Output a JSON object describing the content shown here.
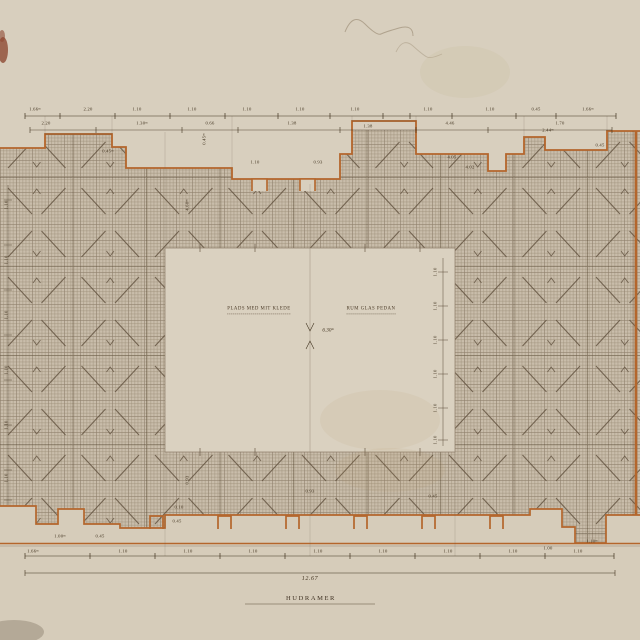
{
  "drawing": {
    "title": "HUDRAMER",
    "overall_dimension": "12.67",
    "center_dimension": "6.30ᵐ",
    "room_label_left": "PLADS MED MIT KLEDE",
    "room_label_right": "RUM GLAS PEDAN"
  },
  "colors": {
    "paper": "#d7cdbc",
    "wall_outline": "#b4662c",
    "ink": "#41331f",
    "hatch_field": "#c9bdab",
    "hatch_line": "#93866f"
  },
  "dim_labels": [
    {
      "x": 35,
      "y": 110,
      "t": "1.66ᵐ"
    },
    {
      "x": 88,
      "y": 110,
      "t": "2.20"
    },
    {
      "x": 137,
      "y": 110,
      "t": "1.10"
    },
    {
      "x": 192,
      "y": 110,
      "t": "1.10"
    },
    {
      "x": 247,
      "y": 110,
      "t": "1.10"
    },
    {
      "x": 300,
      "y": 110,
      "t": "1.10"
    },
    {
      "x": 355,
      "y": 110,
      "t": "1.10"
    },
    {
      "x": 428,
      "y": 110,
      "t": "1.10"
    },
    {
      "x": 490,
      "y": 110,
      "t": "1.10"
    },
    {
      "x": 536,
      "y": 110,
      "t": "0.45"
    },
    {
      "x": 588,
      "y": 110,
      "t": "1.66ᵐ"
    },
    {
      "x": 46,
      "y": 124,
      "t": "2.20"
    },
    {
      "x": 142,
      "y": 124,
      "t": "1.30ᵐ"
    },
    {
      "x": 210,
      "y": 124,
      "t": "0.66"
    },
    {
      "x": 292,
      "y": 124,
      "t": "1.38"
    },
    {
      "x": 368,
      "y": 127,
      "t": "1.38"
    },
    {
      "x": 450,
      "y": 124,
      "t": "4.46"
    },
    {
      "x": 560,
      "y": 124,
      "t": "1.70"
    },
    {
      "x": 205,
      "y": 139,
      "t": "0.45ᵐ",
      "r": true
    },
    {
      "x": 108,
      "y": 152,
      "t": "0.45ᵐ"
    },
    {
      "x": 255,
      "y": 163,
      "t": "1.10"
    },
    {
      "x": 318,
      "y": 163,
      "t": "0.93"
    },
    {
      "x": 452,
      "y": 158,
      "t": "4.05"
    },
    {
      "x": 470,
      "y": 168,
      "t": "4.02"
    },
    {
      "x": 548,
      "y": 131,
      "t": "2.44ᵐ"
    },
    {
      "x": 600,
      "y": 146,
      "t": "0.45"
    },
    {
      "x": 188,
      "y": 205,
      "t": "4.68ᵐ",
      "r": true
    },
    {
      "x": 188,
      "y": 480,
      "t": "0.93",
      "r": true
    },
    {
      "x": 310,
      "y": 492,
      "t": "0.93"
    },
    {
      "x": 433,
      "y": 497,
      "t": "0.45"
    },
    {
      "x": 7,
      "y": 205,
      "t": "1.10",
      "r": true
    },
    {
      "x": 7,
      "y": 260,
      "t": "1.10",
      "r": true
    },
    {
      "x": 7,
      "y": 315,
      "t": "1.10",
      "r": true
    },
    {
      "x": 7,
      "y": 370,
      "t": "1.10",
      "r": true
    },
    {
      "x": 7,
      "y": 425,
      "t": "1.10",
      "r": true
    },
    {
      "x": 7,
      "y": 478,
      "t": "1.10",
      "r": true
    },
    {
      "x": 436,
      "y": 272,
      "t": "1.10",
      "r": true
    },
    {
      "x": 436,
      "y": 306,
      "t": "1.10",
      "r": true
    },
    {
      "x": 436,
      "y": 340,
      "t": "1.10",
      "r": true
    },
    {
      "x": 436,
      "y": 374,
      "t": "1.10",
      "r": true
    },
    {
      "x": 436,
      "y": 408,
      "t": "1.10",
      "r": true
    },
    {
      "x": 436,
      "y": 440,
      "t": "1.10",
      "r": true
    },
    {
      "x": 33,
      "y": 552,
      "t": "1.66ᵐ"
    },
    {
      "x": 123,
      "y": 552,
      "t": "1.10"
    },
    {
      "x": 188,
      "y": 552,
      "t": "1.10"
    },
    {
      "x": 253,
      "y": 552,
      "t": "1.10"
    },
    {
      "x": 318,
      "y": 552,
      "t": "1.10"
    },
    {
      "x": 383,
      "y": 552,
      "t": "1.10"
    },
    {
      "x": 448,
      "y": 552,
      "t": "1.10"
    },
    {
      "x": 513,
      "y": 552,
      "t": "1.10"
    },
    {
      "x": 578,
      "y": 552,
      "t": "1.10"
    },
    {
      "x": 60,
      "y": 537,
      "t": "1.00ᵐ"
    },
    {
      "x": 100,
      "y": 537,
      "t": "0.45"
    },
    {
      "x": 177,
      "y": 522,
      "t": "0.45"
    },
    {
      "x": 179,
      "y": 508,
      "t": "0.10"
    },
    {
      "x": 548,
      "y": 549,
      "t": "1.00"
    },
    {
      "x": 592,
      "y": 542,
      "t": "1.10ᵐ"
    }
  ]
}
